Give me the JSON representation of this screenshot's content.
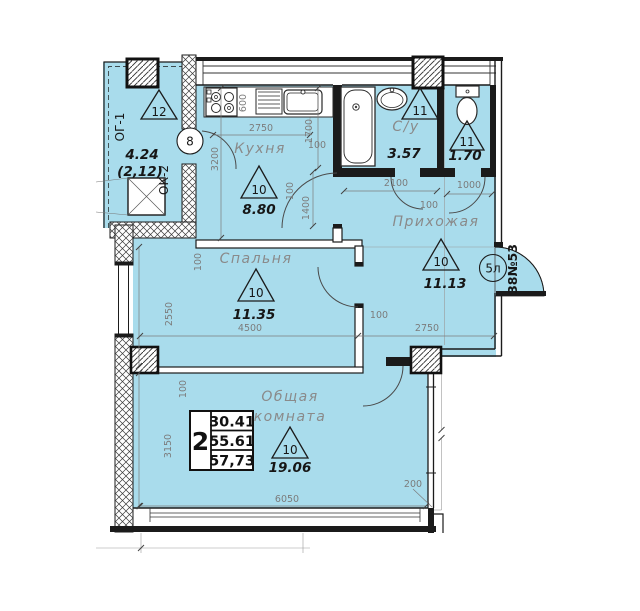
{
  "title": "Apartment floor plan",
  "colors": {
    "room_fill": "#a9dcec",
    "wall_black": "#1b1b1b",
    "label_gray": "#8a8a8a",
    "dim_gray": "#7c7c7c"
  },
  "rooms": {
    "kitchen": {
      "label": "Кухня",
      "triangle": "10",
      "area": "8.80"
    },
    "bathroom": {
      "label": "С/у",
      "triangle": "11",
      "area": "3.57"
    },
    "toilet": {
      "triangle": "11",
      "area": "1.70"
    },
    "hallway": {
      "label": "Прихожая",
      "triangle": "10",
      "area": "11.13"
    },
    "bedroom": {
      "label": "Спальня",
      "triangle": "10",
      "area": "11.35"
    },
    "living_room": {
      "label_line1": "Общая",
      "label_line2": "комната",
      "triangle": "10",
      "area": "19.06"
    },
    "balcony": {
      "window_label_1": "ОГ-1",
      "window_label_2": "ОК-2",
      "triangle": "12",
      "area": "4.24",
      "area_reduced": "(2,12)"
    }
  },
  "markers": {
    "balcony_door_number": "8",
    "entrance_door_number": "5л",
    "apartment_number": "38№53"
  },
  "stamp": {
    "room_count": "2",
    "living_area": "30.41",
    "apartment_area": "55.61",
    "total_area": "57,73"
  },
  "dims": {
    "d2750": "2750",
    "d1700": "1700",
    "d3200": "3200",
    "d600": "600",
    "d100": "100",
    "d2100": "2100",
    "d1000": "1000",
    "d1400": "1400",
    "d2550": "2550",
    "d4500": "4500",
    "d3150": "3150",
    "d6050": "6050",
    "d200": "200"
  }
}
